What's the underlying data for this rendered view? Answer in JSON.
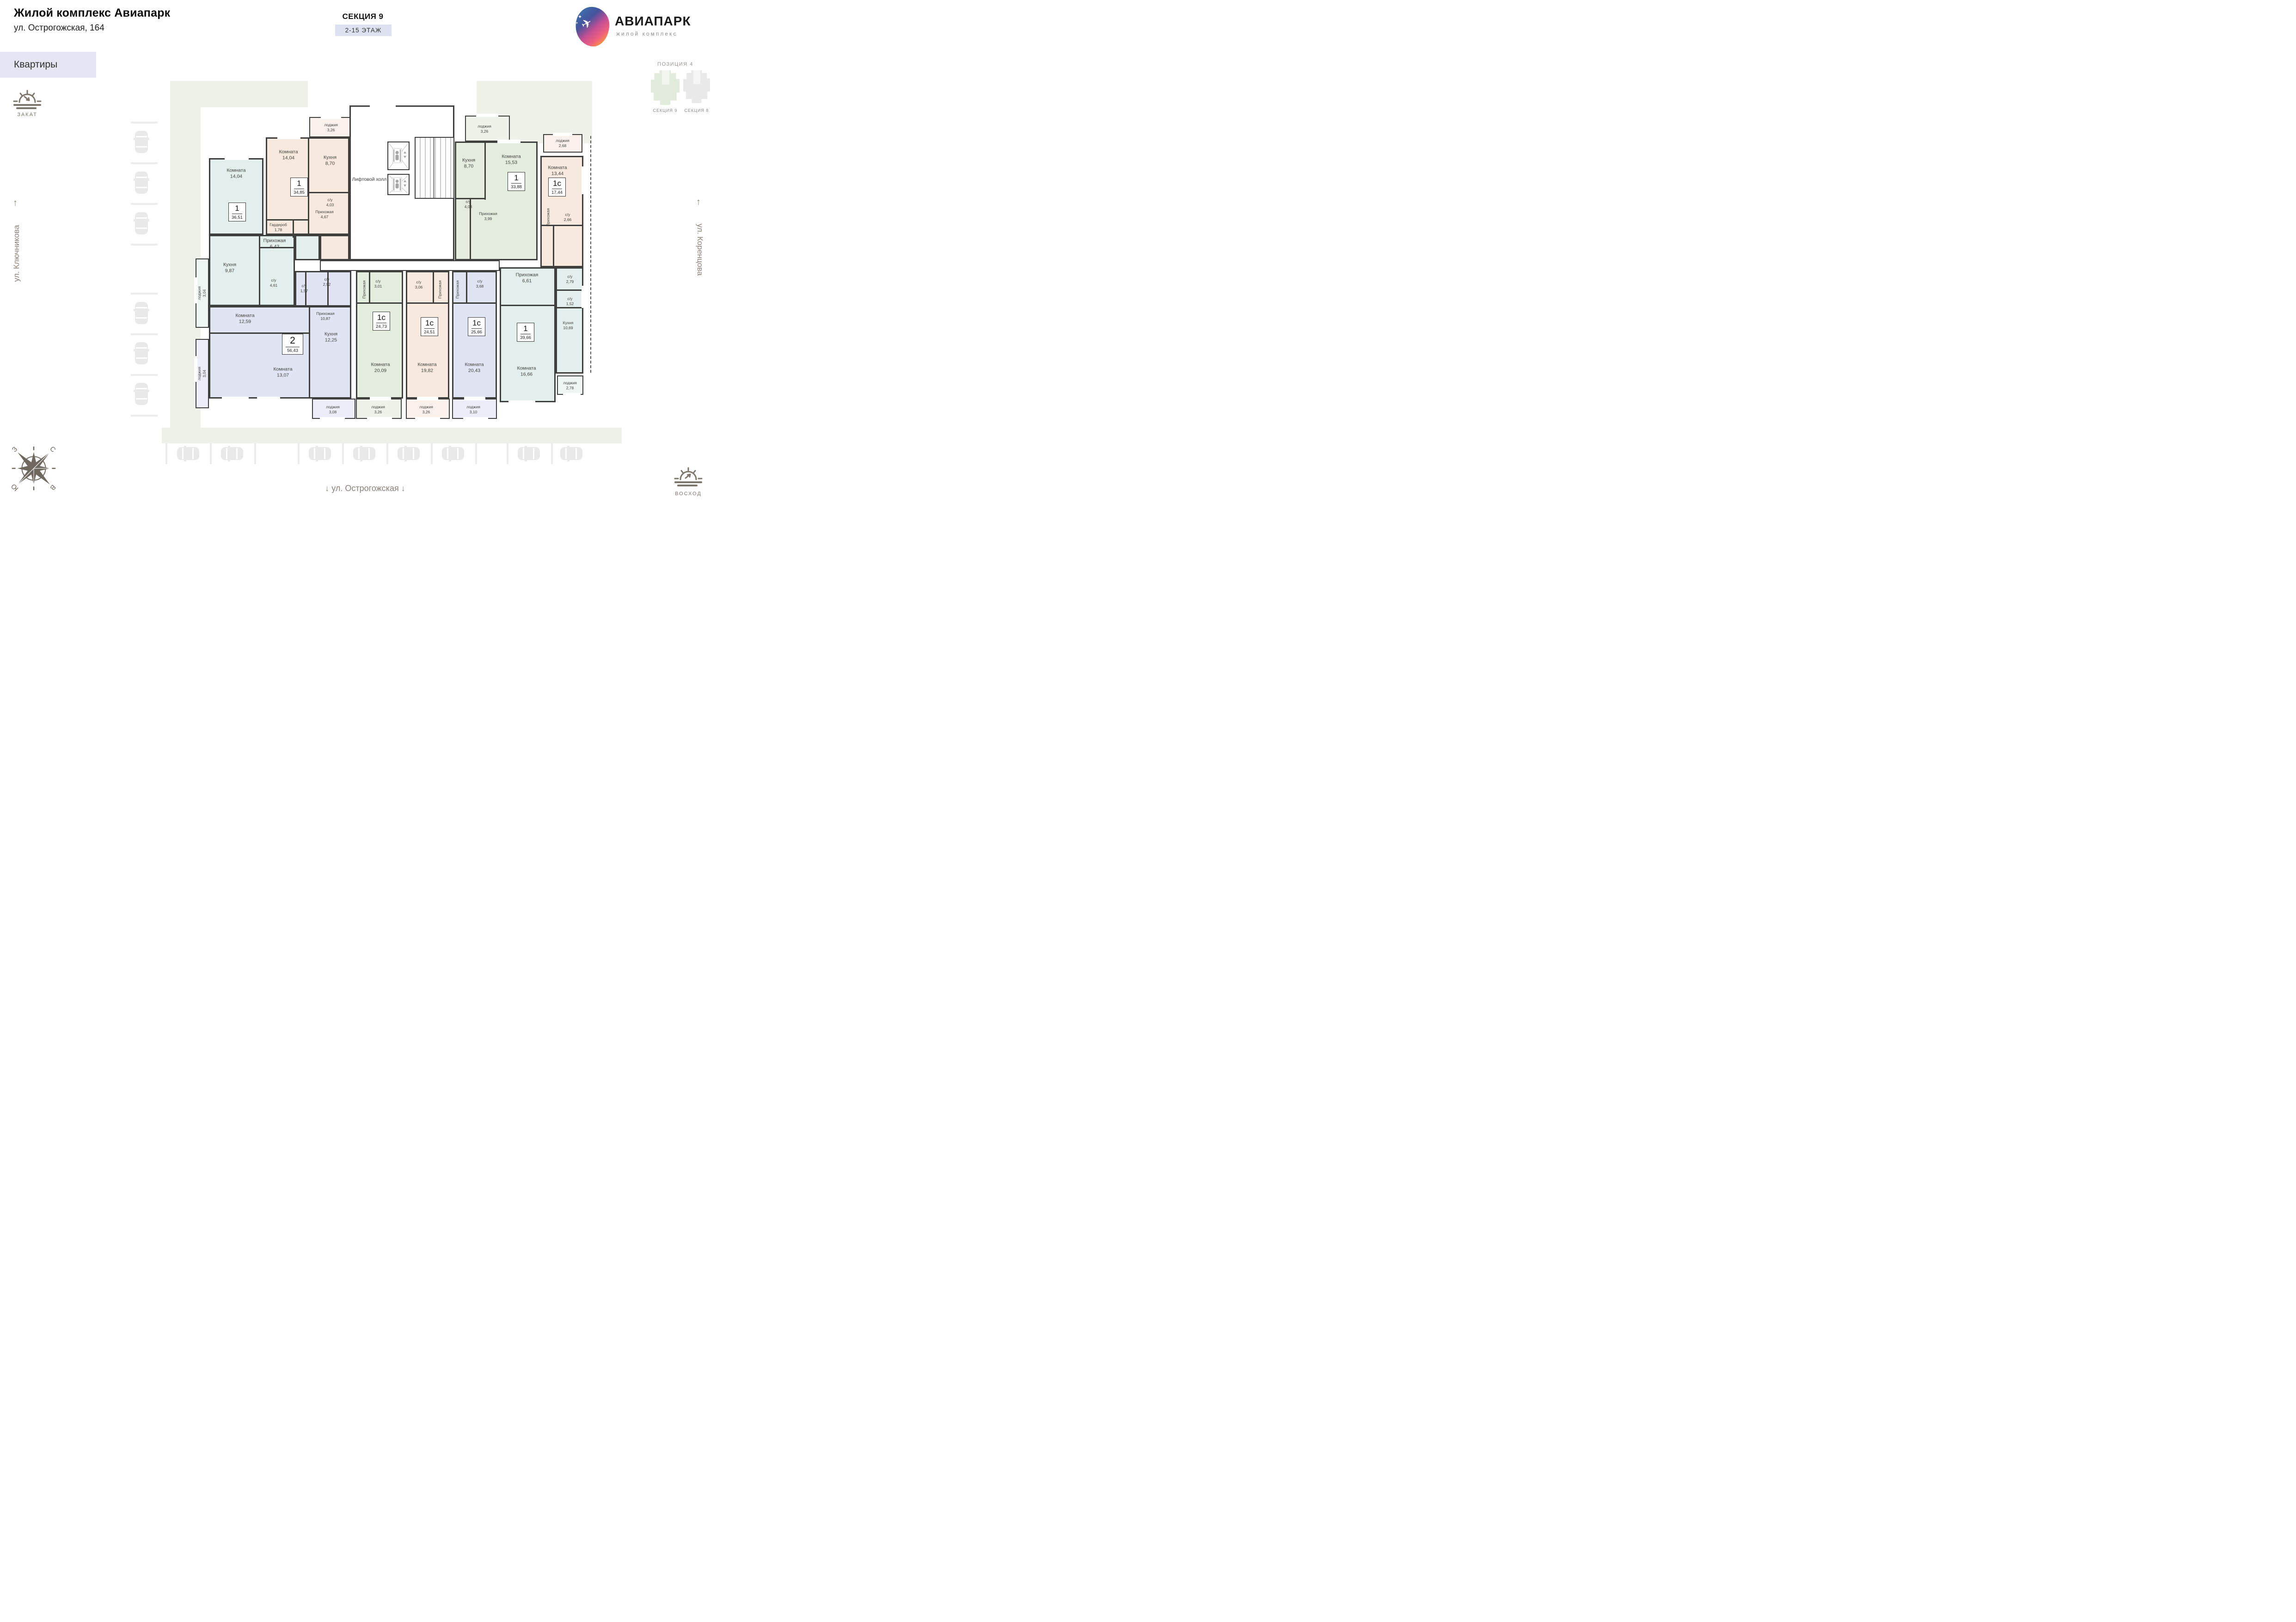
{
  "header": {
    "title": "Жилой комплекс Авиапарк",
    "address": "ул. Острогожская, 164",
    "tab": "Квартиры"
  },
  "section": {
    "name": "СЕКЦИЯ 9",
    "floors": "2-15 ЭТАЖ"
  },
  "logo": {
    "name": "АВИАПАРК",
    "subtitle": "жилой комплекс"
  },
  "icons": {
    "plane": "✈",
    "sparkle": "✦",
    "up_arrow": "↑",
    "down_arrow": "↓"
  },
  "position_map": {
    "title": "ПОЗИЦИЯ 4",
    "sections": [
      {
        "label": "СЕКЦИЯ 9",
        "color": "#e3ecdc"
      },
      {
        "label": "СЕКЦИЯ 8",
        "color": "#e9e9e9"
      }
    ]
  },
  "orientation": {
    "sunset": "ЗАКАТ",
    "sunrise": "ВОСХОД",
    "compass": {
      "n": "С",
      "s": "Ю",
      "w": "З",
      "e": "В"
    }
  },
  "streets": {
    "left": "ул. Ключникова",
    "right": "ул. Коренцова",
    "bottom": "ул. Острогожская"
  },
  "core": {
    "hall": "Лифтовой холл"
  },
  "colors": {
    "wall": "#3f3f3d",
    "site": "#eef1e7"
  },
  "apartments": [
    {
      "id": "A",
      "type": "1",
      "area": "36,51",
      "color": "#e2efec",
      "loggia_color": "#edf6f3",
      "rooms": [
        {
          "id": "a-room",
          "name": "Комната",
          "value": "14,04"
        },
        {
          "id": "a-loggia",
          "name": "лоджия",
          "value": "3,04"
        },
        {
          "id": "a-kitchen",
          "name": "Кухня",
          "value": "9,87"
        },
        {
          "id": "a-su",
          "name": "с/у",
          "value": "4,61"
        },
        {
          "id": "a-hall",
          "name": "Прихожая",
          "value": "6,42"
        }
      ]
    },
    {
      "id": "B",
      "type": "1",
      "area": "34,85",
      "color": "#f7e9de",
      "loggia_color": "#faf1ea",
      "rooms": [
        {
          "id": "b-loggia",
          "name": "лоджия",
          "value": "3,26"
        },
        {
          "id": "b-room",
          "name": "Комната",
          "value": "14,04"
        },
        {
          "id": "b-kitchen",
          "name": "Кухня",
          "value": "8,70"
        },
        {
          "id": "b-su",
          "name": "с/у",
          "value": "4,03"
        },
        {
          "id": "b-ward",
          "name": "Гардероб",
          "value": "1,78"
        },
        {
          "id": "b-hall",
          "name": "Прихожая",
          "value": "4,67"
        }
      ]
    },
    {
      "id": "C",
      "type": "1",
      "area": "33,88",
      "color": "#e4ecde",
      "loggia_color": "#eef3e9",
      "rooms": [
        {
          "id": "c-loggia",
          "name": "лоджия",
          "value": "3,26"
        },
        {
          "id": "c-kitchen",
          "name": "Кухня",
          "value": "8,70"
        },
        {
          "id": "c-room",
          "name": "Комната",
          "value": "15,53"
        },
        {
          "id": "c-su",
          "name": "с/у",
          "value": "4,03"
        },
        {
          "id": "c-hall",
          "name": "Прихожая",
          "value": "3,99"
        }
      ]
    },
    {
      "id": "D",
      "type": "1с",
      "area": "17,44",
      "color": "#f7e9de",
      "loggia_color": "#faf1ea",
      "rooms": [
        {
          "id": "d-loggia",
          "name": "лоджия",
          "value": "2,68"
        },
        {
          "id": "d-room",
          "name": "Комната",
          "value": "13,44"
        },
        {
          "id": "d-hall",
          "name": "Прихожая",
          "value": ""
        },
        {
          "id": "d-su",
          "name": "с/у",
          "value": "2,66"
        }
      ]
    },
    {
      "id": "E",
      "type": "2",
      "area": "56,43",
      "color": "#e1e4f3",
      "loggia_color": "#ebeef8",
      "rooms": [
        {
          "id": "e-loggia1",
          "name": "лоджия",
          "value": "3,04"
        },
        {
          "id": "e-room1",
          "name": "Комната",
          "value": "12,59"
        },
        {
          "id": "e-su1",
          "name": "с/у",
          "value": "1,57"
        },
        {
          "id": "e-su2",
          "name": "с/у",
          "value": "2,92"
        },
        {
          "id": "e-hall",
          "name": "Прихожая",
          "value": "10,87"
        },
        {
          "id": "e-kitchen",
          "name": "Кухня",
          "value": "12,25"
        },
        {
          "id": "e-room2",
          "name": "Комната",
          "value": "13,07"
        },
        {
          "id": "e-loggia2",
          "name": "лоджия",
          "value": "3,08"
        }
      ]
    },
    {
      "id": "F",
      "type": "1с",
      "area": "24,73",
      "color": "#e4ecde",
      "loggia_color": "#eef3e9",
      "rooms": [
        {
          "id": "f-hall",
          "name": "Прихожая",
          "value": ""
        },
        {
          "id": "f-su",
          "name": "с/у",
          "value": "3,01"
        },
        {
          "id": "f-room",
          "name": "Комната",
          "value": "20,09"
        },
        {
          "id": "f-loggia",
          "name": "лоджия",
          "value": "3,26"
        }
      ]
    },
    {
      "id": "G",
      "type": "1с",
      "area": "24,51",
      "color": "#f7e9de",
      "loggia_color": "#faf1ea",
      "rooms": [
        {
          "id": "g-su",
          "name": "с/у",
          "value": "3,06"
        },
        {
          "id": "g-hall",
          "name": "Прихожая",
          "value": ""
        },
        {
          "id": "g-room",
          "name": "Комната",
          "value": "19,82"
        },
        {
          "id": "g-loggia",
          "name": "лоджия",
          "value": "3,26"
        }
      ]
    },
    {
      "id": "H",
      "type": "1с",
      "area": "25,66",
      "color": "#e1e4f3",
      "loggia_color": "#ebeef8",
      "rooms": [
        {
          "id": "h-hall",
          "name": "Прихожая",
          "value": ""
        },
        {
          "id": "h-su",
          "name": "с/у",
          "value": "3,68"
        },
        {
          "id": "h-room",
          "name": "Комната",
          "value": "20,43"
        },
        {
          "id": "h-loggia",
          "name": "лоджия",
          "value": "3,10"
        }
      ]
    },
    {
      "id": "I",
      "type": "1",
      "area": "39,66",
      "color": "#e2efec",
      "loggia_color": "#edf6f3",
      "rooms": [
        {
          "id": "i-hall",
          "name": "Прихожая",
          "value": "6,61"
        },
        {
          "id": "i-su1",
          "name": "с/у",
          "value": "2,79"
        },
        {
          "id": "i-su2",
          "name": "с/у",
          "value": "1,52"
        },
        {
          "id": "i-kitchen",
          "name": "Кухня",
          "value": "10,69"
        },
        {
          "id": "i-room",
          "name": "Комната",
          "value": "16,66"
        },
        {
          "id": "i-loggia",
          "name": "лоджия",
          "value": "2,78"
        }
      ]
    }
  ]
}
